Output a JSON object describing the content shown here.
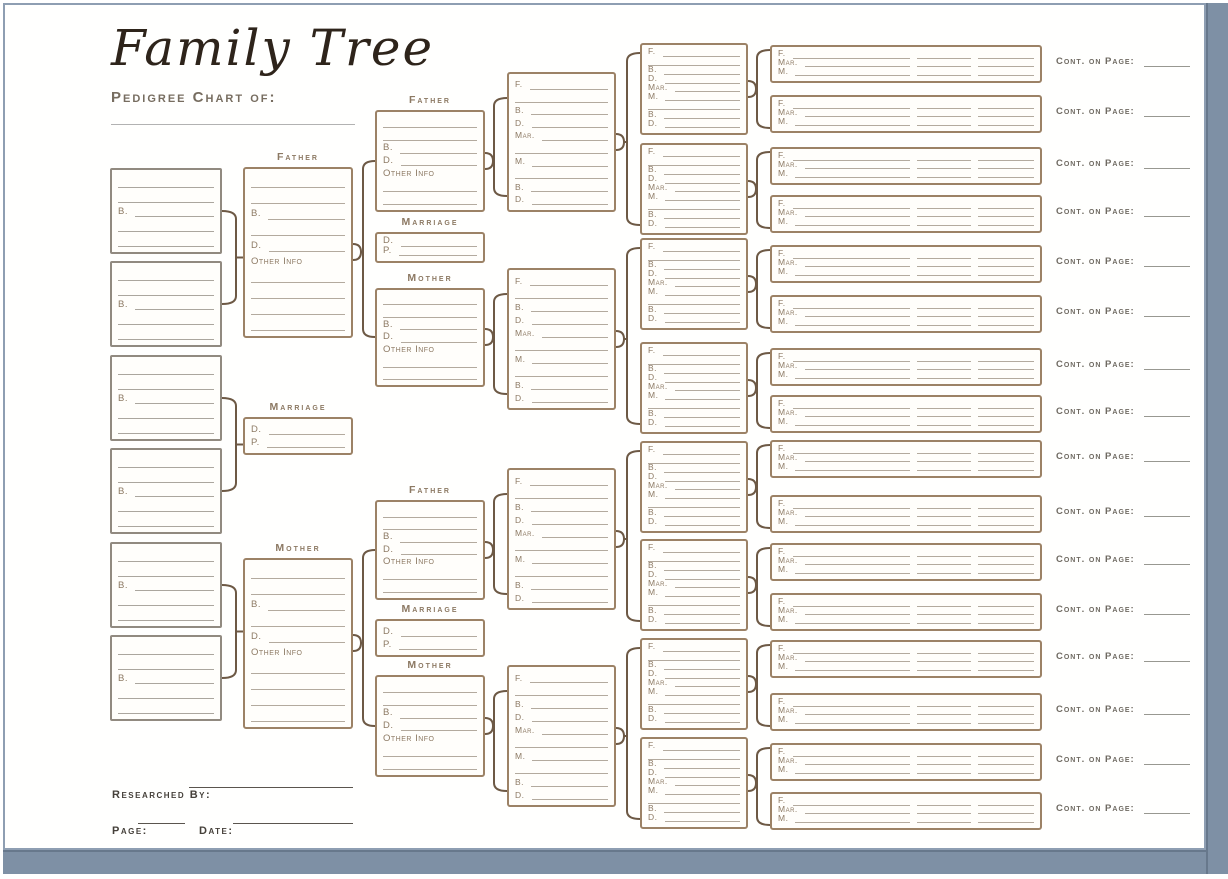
{
  "header": {
    "title": "Family Tree",
    "subtitle": "Pedigree Chart of:"
  },
  "labels": {
    "father": "Father",
    "mother": "Mother",
    "marriage": "Marriage",
    "cont_on_page": "Cont. on Page:"
  },
  "fields": {
    "f": "F.",
    "b": "B.",
    "d": "D.",
    "m": "M.",
    "mar": "Mar.",
    "p": "P.",
    "other_info": "Other Info"
  },
  "box_templates": {
    "child": [
      "",
      "",
      "b",
      "",
      ""
    ],
    "parent": [
      "",
      "",
      "b",
      "",
      "d",
      "other_info",
      "",
      "",
      "",
      ""
    ],
    "grandparent": [
      "",
      "",
      "b",
      "d",
      "other_info",
      "",
      ""
    ],
    "marriage": [
      "d",
      "p"
    ],
    "couple4": [
      "f",
      "",
      "b",
      "d",
      "mar",
      "",
      "m",
      "",
      "b",
      "d"
    ],
    "couple5": [
      "f",
      "",
      "b",
      "d",
      "mar",
      "m",
      "",
      "b",
      "d"
    ],
    "couple6": [
      "f",
      "mar",
      "m"
    ]
  },
  "footer": {
    "researched_by": "Researched By:",
    "page": "Page:",
    "date": "Date:"
  },
  "colors": {
    "box_border": "#9c8266",
    "child_box_border": "#918a80",
    "connector": "#6d5945",
    "field_line": "#b3aa9e",
    "section_label": "#8c7963",
    "frame_border": "#8e9eb2",
    "frame_shadow": "#7e90a5",
    "title_text": "#2e241b",
    "subtitle_text": "#776d60"
  }
}
